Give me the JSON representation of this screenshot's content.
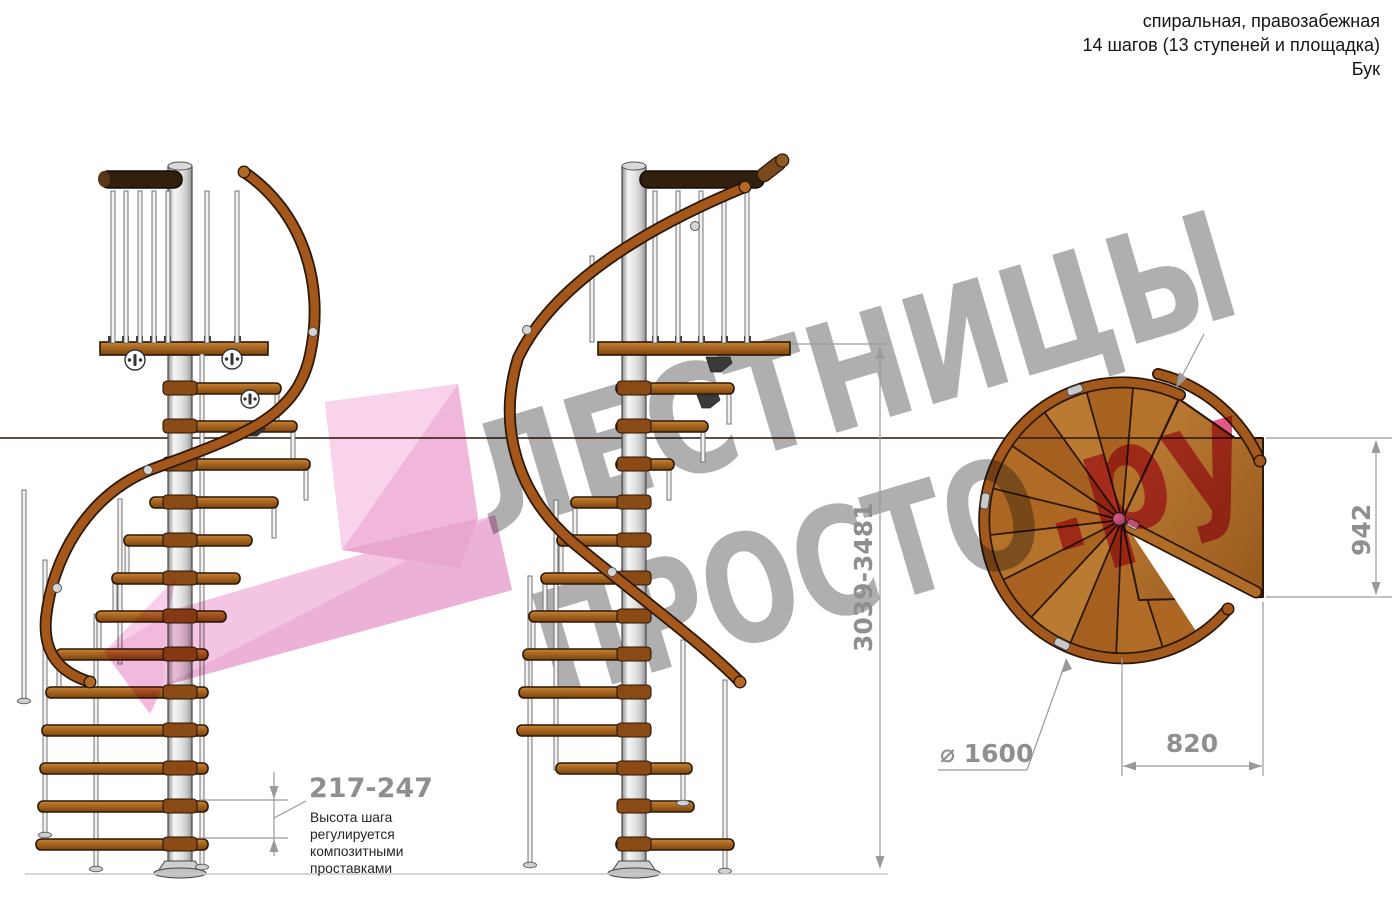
{
  "header": {
    "type_line": "спиральная, правозабежная",
    "steps_line": "14 шагов (13 ступеней и площадка)",
    "material_line": "Бук"
  },
  "watermark": {
    "word1": "ЛЕСТНИЦЫ",
    "word2": "ПРОСТО",
    "suffix": ".ру"
  },
  "dimensions": {
    "total_height": "3039-3481",
    "landing_width": "942",
    "landing_depth": "820",
    "diameter": "⌀ 1600",
    "step_height": "217-247"
  },
  "step_note": {
    "l1": "Высота шага",
    "l2": "регулируется",
    "l3": "композитными",
    "l4": "проставками"
  },
  "colors": {
    "wood": "#b06c26",
    "wood_outline": "#2b1708",
    "rail_wood": "#a3571b",
    "dark_top_rail": "#32200f",
    "metal": "#f2f2f2",
    "dim_gray": "#9a9a9a",
    "text_dark": "#252525",
    "watermark_gray": "#ababab",
    "watermark_pink": "#dd5380",
    "arrow_pink": "#f0b1d8"
  }
}
